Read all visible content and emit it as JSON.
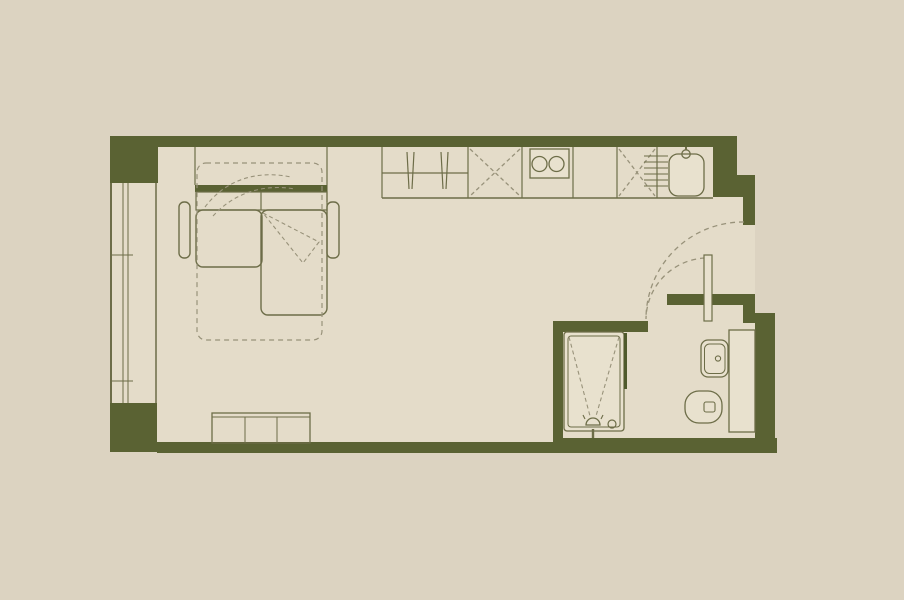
{
  "meta": {
    "description": "studio apartment floor plan, no visible text"
  },
  "colors": {
    "background": "#dcd3c1",
    "floor": "#e4dcc9",
    "wall": "#5a6233",
    "line": "#6d6d48",
    "dashline": "#98927a",
    "fixture": "#e8e1ce",
    "glass": "#4f5a2c"
  },
  "canvas": {
    "width": 904,
    "height": 600
  },
  "floor_plan": {
    "groups": [
      {
        "name": "floor-area",
        "items": [
          {
            "t": "rect",
            "name": "interior-floor",
            "x": 112,
            "y": 140,
            "w": 643,
            "h": 312,
            "fill": "floor",
            "ns": true
          },
          {
            "t": "rect",
            "name": "outside-patch-top-right",
            "x": 737,
            "y": 126,
            "w": 22,
            "h": 51,
            "fill": "background",
            "ns": true
          }
        ]
      },
      {
        "name": "walls",
        "items": [
          {
            "t": "rect",
            "name": "top-wall",
            "x": 110,
            "y": 136,
            "w": 627,
            "h": 11,
            "fill": "wall",
            "ns": true
          },
          {
            "t": "rect",
            "name": "top-left-pier",
            "x": 110,
            "y": 136,
            "w": 48,
            "h": 47,
            "fill": "wall",
            "ns": true
          },
          {
            "t": "rect",
            "name": "bottom-left-pier",
            "x": 110,
            "y": 403,
            "w": 47,
            "h": 49,
            "fill": "wall",
            "ns": true
          },
          {
            "t": "rect",
            "name": "bottom-wall",
            "x": 157,
            "y": 442,
            "w": 398,
            "h": 11,
            "fill": "wall",
            "ns": true
          },
          {
            "t": "rect",
            "name": "bottom-wall-bathroom",
            "x": 553,
            "y": 438,
            "w": 224,
            "h": 15,
            "fill": "wall",
            "ns": true
          },
          {
            "t": "rect",
            "name": "right-wall-upper",
            "x": 713,
            "y": 136,
            "w": 24,
            "h": 61,
            "fill": "wall",
            "ns": true
          },
          {
            "t": "rect",
            "name": "right-wall-step",
            "x": 735,
            "y": 175,
            "w": 20,
            "h": 22,
            "fill": "wall",
            "ns": true
          },
          {
            "t": "rect",
            "name": "entry-door-jamb",
            "x": 743,
            "y": 197,
            "w": 12,
            "h": 28,
            "fill": "wall",
            "ns": true
          },
          {
            "t": "rect",
            "name": "entry-stub-wall",
            "x": 667,
            "y": 294,
            "w": 76,
            "h": 11,
            "fill": "wall",
            "ns": true
          },
          {
            "t": "rect",
            "name": "entry-stub-step",
            "x": 743,
            "y": 294,
            "w": 12,
            "h": 29,
            "fill": "wall",
            "ns": true
          },
          {
            "t": "rect",
            "name": "right-wall-lower",
            "x": 755,
            "y": 313,
            "w": 20,
            "h": 130,
            "fill": "wall",
            "ns": true
          },
          {
            "t": "rect",
            "name": "bathroom-top-wall",
            "x": 553,
            "y": 321,
            "w": 95,
            "h": 11,
            "fill": "wall",
            "ns": true
          },
          {
            "t": "rect",
            "name": "bathroom-left-wall",
            "x": 553,
            "y": 321,
            "w": 10,
            "h": 124,
            "fill": "wall",
            "ns": true
          }
        ]
      },
      {
        "name": "window-left",
        "items": [
          {
            "t": "line",
            "name": "window-outer-line",
            "x1": 111,
            "y1": 183,
            "x2": 111,
            "y2": 403,
            "sw": 2
          },
          {
            "t": "line",
            "name": "window-glazing-line",
            "x1": 123,
            "y1": 183,
            "x2": 123,
            "y2": 403,
            "sw": 1
          },
          {
            "t": "line",
            "name": "window-glazing-line",
            "x1": 128,
            "y1": 183,
            "x2": 128,
            "y2": 403,
            "sw": 1
          },
          {
            "t": "line",
            "name": "window-inner-line",
            "x1": 156,
            "y1": 183,
            "x2": 156,
            "y2": 403,
            "sw": 1.5
          },
          {
            "t": "line",
            "name": "window-mullion-tick",
            "x1": 111,
            "y1": 255,
            "x2": 133,
            "y2": 255,
            "sw": 1
          },
          {
            "t": "line",
            "name": "window-mullion-tick",
            "x1": 111,
            "y1": 381,
            "x2": 133,
            "y2": 381,
            "sw": 1
          }
        ]
      },
      {
        "name": "kitchen-run",
        "items": [
          {
            "t": "line",
            "name": "counter-left-edge",
            "x1": 382,
            "y1": 147,
            "x2": 382,
            "y2": 198,
            "sw": 1.2
          },
          {
            "t": "line",
            "name": "counter-front-edge",
            "x1": 382,
            "y1": 198,
            "x2": 713,
            "y2": 198,
            "sw": 1.6
          },
          {
            "t": "line",
            "name": "unit-divider",
            "x1": 468,
            "y1": 147,
            "x2": 468,
            "y2": 198,
            "sw": 1.2
          },
          {
            "t": "line",
            "name": "unit-divider",
            "x1": 522,
            "y1": 147,
            "x2": 522,
            "y2": 198,
            "sw": 1.2
          },
          {
            "t": "line",
            "name": "unit-divider",
            "x1": 573,
            "y1": 147,
            "x2": 573,
            "y2": 198,
            "sw": 1.2
          },
          {
            "t": "line",
            "name": "unit-divider",
            "x1": 617,
            "y1": 147,
            "x2": 617,
            "y2": 198,
            "sw": 1.2
          },
          {
            "t": "line",
            "name": "unit-divider",
            "x1": 657,
            "y1": 147,
            "x2": 657,
            "y2": 198,
            "sw": 1.2
          },
          {
            "t": "line",
            "name": "wardrobe-rail",
            "x1": 382,
            "y1": 173,
            "x2": 468,
            "y2": 173,
            "sw": 1.2
          },
          {
            "t": "line",
            "name": "hanger-stroke",
            "x1": 407,
            "y1": 152,
            "x2": 409,
            "y2": 189,
            "sw": 1.2
          },
          {
            "t": "line",
            "name": "hanger-stroke",
            "x1": 414,
            "y1": 152,
            "x2": 412,
            "y2": 189,
            "sw": 1.2
          },
          {
            "t": "line",
            "name": "hanger-stroke",
            "x1": 441,
            "y1": 152,
            "x2": 443,
            "y2": 189,
            "sw": 1.2
          },
          {
            "t": "line",
            "name": "hanger-stroke",
            "x1": 448,
            "y1": 152,
            "x2": 446,
            "y2": 189,
            "sw": 1.2
          },
          {
            "t": "line",
            "name": "cabinet-cross",
            "x1": 470,
            "y1": 149,
            "x2": 520,
            "y2": 196,
            "stroke": "dashline",
            "dash": "4 3"
          },
          {
            "t": "line",
            "name": "cabinet-cross",
            "x1": 520,
            "y1": 149,
            "x2": 470,
            "y2": 196,
            "stroke": "dashline",
            "dash": "4 3"
          },
          {
            "t": "line",
            "name": "cabinet-cross",
            "x1": 619,
            "y1": 149,
            "x2": 655,
            "y2": 196,
            "stroke": "dashline",
            "dash": "4 3"
          },
          {
            "t": "line",
            "name": "cabinet-cross",
            "x1": 655,
            "y1": 149,
            "x2": 619,
            "y2": 196,
            "stroke": "dashline",
            "dash": "4 3"
          },
          {
            "t": "rect",
            "name": "cooktop",
            "x": 530,
            "y": 149,
            "w": 39,
            "h": 29,
            "fill": "fixture",
            "sw": 1.3
          },
          {
            "t": "circle",
            "name": "cooktop-burner",
            "cx": 539.5,
            "cy": 164,
            "r": 7.5,
            "sw": 1.3
          },
          {
            "t": "circle",
            "name": "cooktop-burner",
            "cx": 556.5,
            "cy": 164,
            "r": 7.5,
            "sw": 1.3
          },
          {
            "t": "line",
            "name": "sink-drainer-line",
            "x1": 644,
            "y1": 156,
            "x2": 668,
            "y2": 156,
            "sw": 1.1
          },
          {
            "t": "line",
            "name": "sink-drainer-line",
            "x1": 644,
            "y1": 162,
            "x2": 668,
            "y2": 162,
            "sw": 1.1
          },
          {
            "t": "line",
            "name": "sink-drainer-line",
            "x1": 644,
            "y1": 168,
            "x2": 668,
            "y2": 168,
            "sw": 1.1
          },
          {
            "t": "line",
            "name": "sink-drainer-line",
            "x1": 644,
            "y1": 174,
            "x2": 668,
            "y2": 174,
            "sw": 1.1
          },
          {
            "t": "line",
            "name": "sink-drainer-line",
            "x1": 644,
            "y1": 180,
            "x2": 668,
            "y2": 180,
            "sw": 1.1
          },
          {
            "t": "line",
            "name": "sink-drainer-line",
            "x1": 644,
            "y1": 186,
            "x2": 668,
            "y2": 186,
            "sw": 1.1
          },
          {
            "t": "rect",
            "name": "kitchen-sink-basin",
            "x": 669,
            "y": 154,
            "w": 35,
            "h": 42,
            "rx": 9,
            "fill": "fixture",
            "sw": 1.3
          },
          {
            "t": "line",
            "name": "faucet-stem",
            "x1": 686,
            "y1": 147,
            "x2": 686,
            "y2": 150,
            "sw": 2
          },
          {
            "t": "circle",
            "name": "faucet-head",
            "cx": 686,
            "cy": 154,
            "r": 4.2,
            "sw": 1.3
          }
        ]
      },
      {
        "name": "sofa-bed",
        "items": [
          {
            "t": "line",
            "name": "alcove-side-line",
            "x1": 195,
            "y1": 147,
            "x2": 195,
            "y2": 185,
            "sw": 1.2
          },
          {
            "t": "line",
            "name": "alcove-side-line",
            "x1": 327,
            "y1": 147,
            "x2": 327,
            "y2": 202,
            "sw": 1.2
          },
          {
            "t": "rect",
            "name": "sofa-back-panel",
            "x": 195,
            "y": 185,
            "w": 132,
            "h": 7,
            "fill": "wall",
            "ns": true
          },
          {
            "t": "rect",
            "name": "sofa-back-cushions",
            "x": 196,
            "y": 192,
            "w": 131,
            "h": 18,
            "sw": 1.2
          },
          {
            "t": "line",
            "name": "back-cushion-divider",
            "x1": 261,
            "y1": 192,
            "x2": 261,
            "y2": 210,
            "sw": 1.2
          },
          {
            "t": "rect",
            "name": "seat-cushion",
            "x": 196,
            "y": 210,
            "w": 66,
            "h": 57,
            "rx": 7,
            "sw": 1.4
          },
          {
            "t": "rect",
            "name": "chaise-cushion",
            "x": 261,
            "y": 210,
            "w": 66,
            "h": 105,
            "rx": 7,
            "sw": 1.4
          },
          {
            "t": "rect",
            "name": "armrest-left",
            "x": 179,
            "y": 202,
            "w": 11,
            "h": 56,
            "rx": 5,
            "sw": 1.4
          },
          {
            "t": "rect",
            "name": "armrest-right",
            "x": 327,
            "y": 202,
            "w": 12,
            "h": 56,
            "rx": 5,
            "sw": 1.4
          },
          {
            "t": "rect",
            "name": "bed-unfolded-outline",
            "x": 197,
            "y": 163,
            "w": 125,
            "h": 177,
            "rx": 9,
            "stroke": "dashline",
            "dash": "5 4",
            "sw": 1.2
          },
          {
            "t": "path",
            "name": "fold-direction-arc",
            "d": "M205,207 C226,179 258,170 291,177",
            "stroke": "dashline",
            "dash": "4 3",
            "sw": 1.1
          },
          {
            "t": "path",
            "name": "fold-direction-arc",
            "d": "M213,216 C236,191 266,184 295,189",
            "stroke": "dashline",
            "dash": "4 3",
            "sw": 1.1
          },
          {
            "t": "path",
            "name": "fold-direction-arrow",
            "d": "M263,213 L319,242 L303,263 Z",
            "stroke": "dashline",
            "dash": "4 3",
            "sw": 1.1
          }
        ]
      },
      {
        "name": "bench-seat",
        "items": [
          {
            "t": "rect",
            "name": "bench-outline",
            "x": 212,
            "y": 413,
            "w": 98,
            "h": 30,
            "sw": 1.3
          },
          {
            "t": "line",
            "name": "bench-top-edge",
            "x1": 212,
            "y1": 417,
            "x2": 310,
            "y2": 417,
            "sw": 1
          },
          {
            "t": "line",
            "name": "bench-divider",
            "x1": 245,
            "y1": 417,
            "x2": 245,
            "y2": 443,
            "sw": 1
          },
          {
            "t": "line",
            "name": "bench-divider",
            "x1": 277,
            "y1": 417,
            "x2": 277,
            "y2": 443,
            "sw": 1
          }
        ]
      },
      {
        "name": "bathroom",
        "items": [
          {
            "t": "rect",
            "name": "shower-tray",
            "x": 564,
            "y": 332,
            "w": 60,
            "h": 99,
            "rx": 3,
            "fill": "fixture",
            "sw": 1.3
          },
          {
            "t": "rect",
            "name": "shower-tray-inner",
            "x": 568,
            "y": 336,
            "w": 52,
            "h": 91,
            "rx": 3,
            "sw": 1
          },
          {
            "t": "line",
            "name": "shower-glass-screen",
            "x1": 625.5,
            "y1": 333,
            "x2": 625.5,
            "y2": 389,
            "stroke": "glass",
            "sw": 3
          },
          {
            "t": "line",
            "name": "shower-slope-line",
            "x1": 569,
            "y1": 337,
            "x2": 590,
            "y2": 416,
            "stroke": "dashline",
            "dash": "4 3",
            "sw": 1.1
          },
          {
            "t": "line",
            "name": "shower-slope-line",
            "x1": 619,
            "y1": 337,
            "x2": 596,
            "y2": 416,
            "stroke": "dashline",
            "dash": "4 3",
            "sw": 1.1
          },
          {
            "t": "path",
            "name": "shower-head",
            "d": "M586,425 A7,7 0 0 1 600,425 Z",
            "fill": "fixture",
            "sw": 1.3
          },
          {
            "t": "line",
            "name": "shower-head-tick",
            "x1": 585,
            "y1": 419,
            "x2": 583,
            "y2": 415,
            "sw": 1.1
          },
          {
            "t": "line",
            "name": "shower-head-tick",
            "x1": 601,
            "y1": 419,
            "x2": 603,
            "y2": 415,
            "sw": 1.1
          },
          {
            "t": "line",
            "name": "shower-head-stem",
            "x1": 593,
            "y1": 429,
            "x2": 593,
            "y2": 438,
            "sw": 2.4
          },
          {
            "t": "circle",
            "name": "shower-drain",
            "cx": 612,
            "cy": 424,
            "r": 4,
            "sw": 1.2
          },
          {
            "t": "rect",
            "name": "vanity-counter",
            "x": 729,
            "y": 330,
            "w": 26,
            "h": 102,
            "fill": "fixture",
            "sw": 1.3
          },
          {
            "t": "rect",
            "name": "wash-basin",
            "x": 701,
            "y": 340,
            "w": 27,
            "h": 37,
            "rx": 7,
            "fill": "fixture",
            "sw": 1.3
          },
          {
            "t": "rect",
            "name": "wash-basin-inner",
            "x": 704.5,
            "y": 344,
            "w": 20.5,
            "h": 29.5,
            "rx": 5,
            "sw": 1
          },
          {
            "t": "circle",
            "name": "basin-faucet-dot",
            "cx": 718,
            "cy": 358.5,
            "r": 2.6,
            "sw": 1.1
          },
          {
            "t": "rect",
            "name": "toilet-bowl",
            "x": 685,
            "y": 391,
            "w": 37,
            "h": 32,
            "rx": 14,
            "fill": "fixture",
            "sw": 1.3
          },
          {
            "t": "rect",
            "name": "toilet-flush-button",
            "x": 704,
            "y": 402,
            "w": 11,
            "h": 10,
            "rx": 2,
            "sw": 1.1
          }
        ]
      },
      {
        "name": "doors",
        "items": [
          {
            "t": "path",
            "name": "entry-door-swing-arc",
            "d": "M744,222 A97,97 0 0 0 646,318",
            "stroke": "dashline",
            "dash": "5 4",
            "sw": 1.3
          },
          {
            "t": "path",
            "name": "bathroom-door-swing-arc",
            "d": "M705,258 A62,62 0 0 0 646,319",
            "stroke": "dashline",
            "dash": "5 4",
            "sw": 1.3
          },
          {
            "t": "rect",
            "name": "bathroom-door-leaf",
            "x": 704,
            "y": 255,
            "w": 8,
            "h": 66,
            "fill": "fixture",
            "sw": 1.2
          }
        ]
      }
    ]
  }
}
